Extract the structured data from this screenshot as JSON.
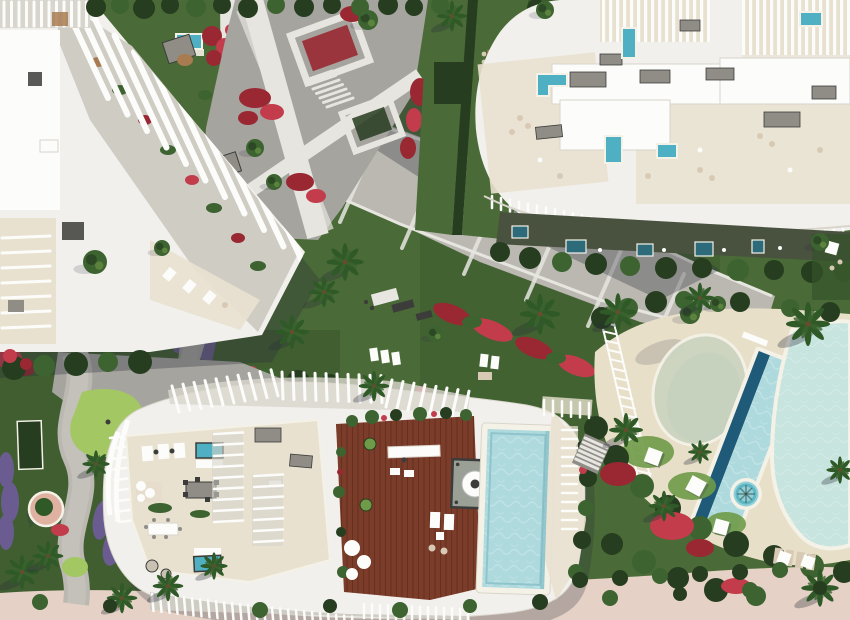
{
  "scene": {
    "description": "Aerial 3D architectural render of a coastal residential resort complex with white organic buildings, rooftop terraces, pools, gardens and promenades",
    "areas": [
      "curved-fin-apartment-building",
      "top-garden-lawn",
      "plaza-walkways",
      "diagonal-promenade",
      "terraced-apartment-building",
      "private-terrace-pools",
      "central-gardens",
      "penthouse-roof-building",
      "wooden-roof-deck",
      "roof-deck-pool",
      "community-pool-complex",
      "lap-pool",
      "spa-pool",
      "mini-golf-garden",
      "south-garden",
      "beach-path"
    ]
  },
  "palette": {
    "white": "#f1f0ec",
    "roof": "#fcfcfa",
    "cream": "#e9e1d0",
    "deckcream": "#e8dfc9",
    "pave": "#a6a49e",
    "pavelight": "#bab8b1",
    "slab": "#e7e5df",
    "lawn": "#4a6b37",
    "lawndark": "#35522a",
    "lawnbright": "#6f9a48",
    "golf": "#a3c763",
    "hedge": "#263d20",
    "foliage": "#3c6330",
    "palm": "#2f5a28",
    "red": "#992832",
    "crimson": "#c23c4c",
    "purple": "#6a5c90",
    "poolturq": "#4fb0c4",
    "pooldeep": "#2d6b7a",
    "poolnavy": "#1f5a78",
    "poollight": "#aedade",
    "poolpale": "#c7e4df",
    "beachpale": "#ccd5c1",
    "spa": "#8fd0d8",
    "wood": "#7b3c2a",
    "tablewood": "#a87c50",
    "sand": "#e5d1c5",
    "pink": "#dfb1a1",
    "graybox": "#8f8d86",
    "dark": "#3c3d3a",
    "rim": "#f4f1e7",
    "tan": "#d8c9b4",
    "shadow": "rgba(42,46,60,0.32)",
    "shadowsoft": "rgba(42,46,60,0.16)"
  }
}
